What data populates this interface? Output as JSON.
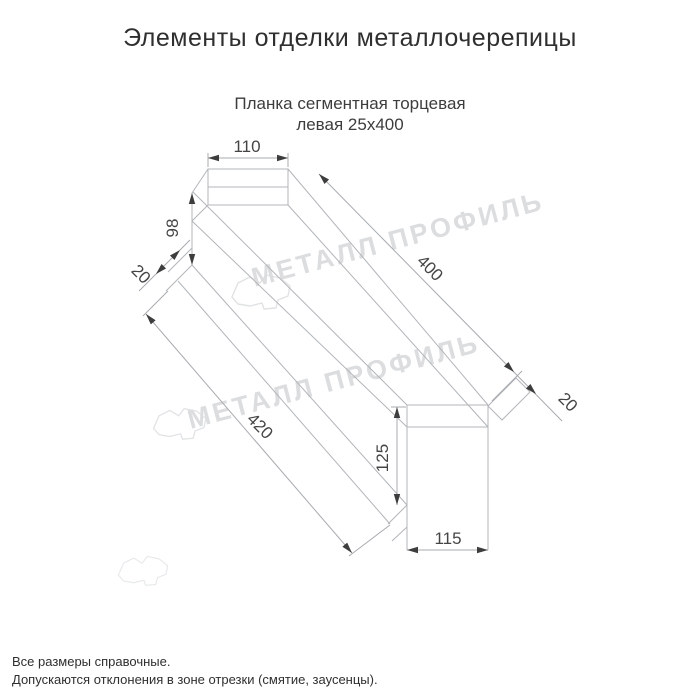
{
  "title": "Элементы отделки металлочерепицы",
  "subtitle": {
    "line1": "Планка сегментная торцевая",
    "line2": "левая 25х400"
  },
  "watermark": {
    "text": "МЕТАЛЛ ПРОФИЛЬ",
    "logo": "metal-profile-cloud-logo"
  },
  "drawing": {
    "product": "Планка сегментная торцевая левая 25х400",
    "dimensions": {
      "top_flange_width": "110",
      "back_height": "98",
      "back_flap": "20",
      "length_top": "400",
      "length_bottom": "420",
      "front_flap": "20",
      "front_height": "125",
      "bottom_width": "115"
    }
  },
  "footer": {
    "note1": "Все размеры справочные.",
    "note2": "Допускаются отклонения в зоне отрезки (смятие, заусенцы)."
  },
  "colors": {
    "outline": "#b2b5b9",
    "dimension_text": "#454545",
    "arrow": "#3d3d3d",
    "watermark": "#dbdddf",
    "title_text": "#2f2f2f"
  }
}
